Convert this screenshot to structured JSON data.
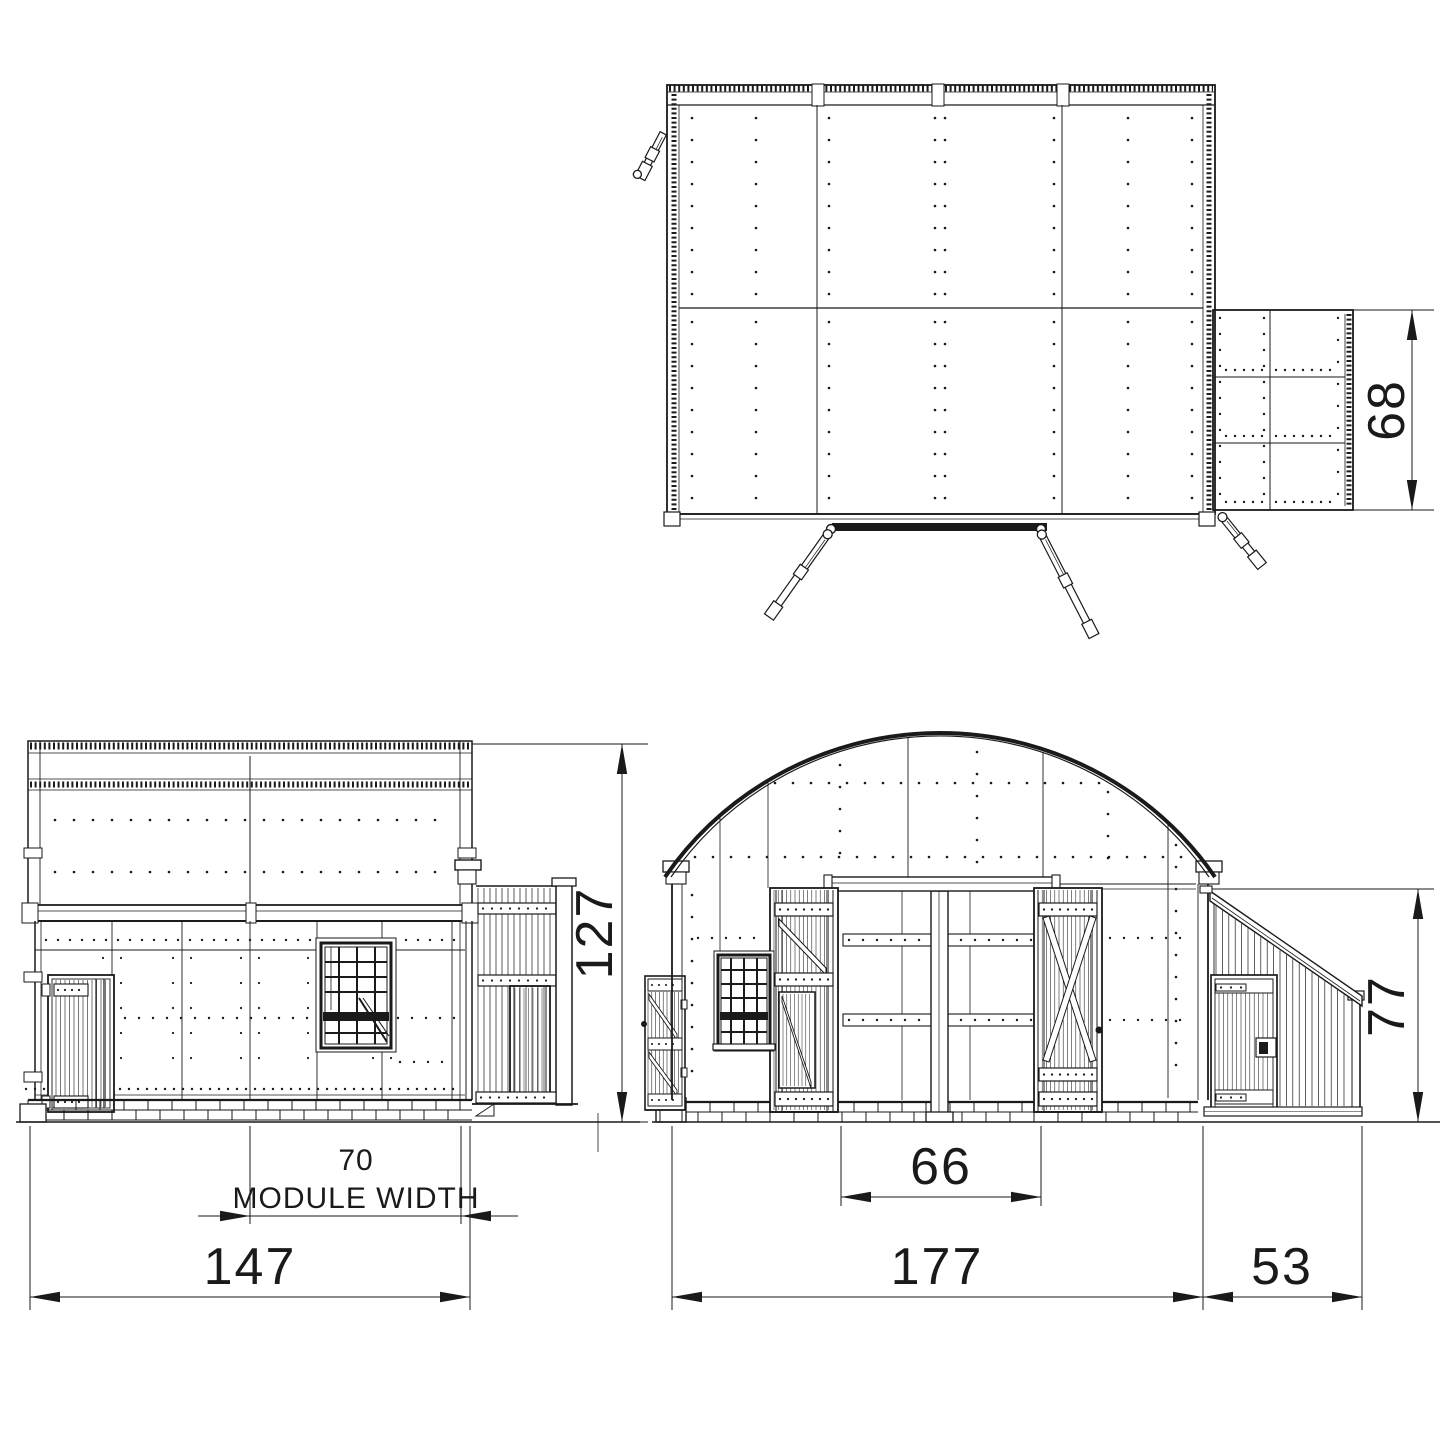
{
  "drawing": {
    "colors": {
      "line": "#1a1a1a",
      "background": "#ffffff"
    },
    "dimensions": {
      "plan_annex_depth": "68",
      "side_total_height": "127",
      "side_module_width_value": "70",
      "side_module_width_label": "MODULE WIDTH",
      "side_total_width": "147",
      "front_door_opening": "66",
      "front_hut_width": "177",
      "front_annex_width": "53",
      "front_annex_height": "77"
    }
  }
}
